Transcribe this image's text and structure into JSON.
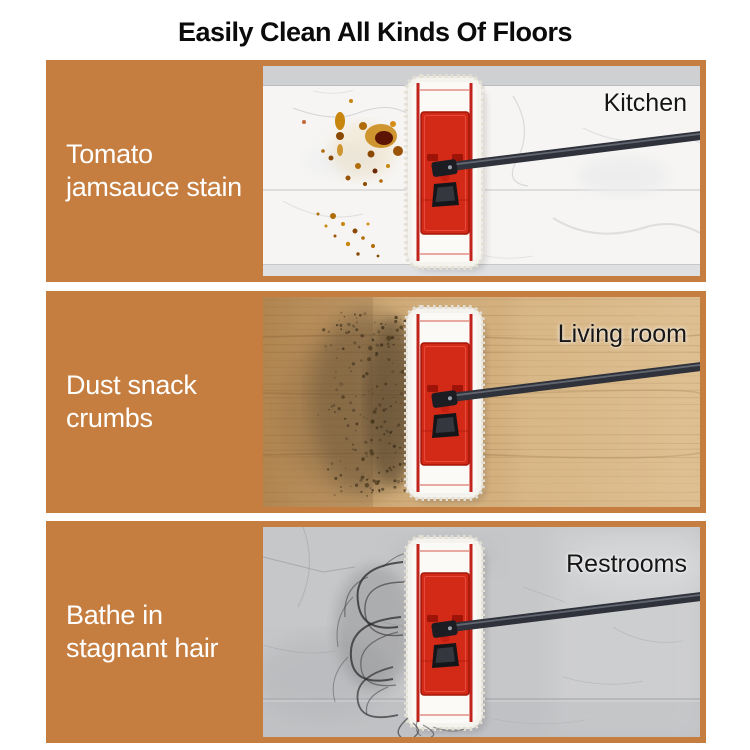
{
  "title": "Easily Clean All Kinds Of Floors",
  "colors": {
    "page_background": "#ffffff",
    "panel_orange": "#c57e40",
    "title_text": "#0b0b0b",
    "stain_label_text": "#ffffff",
    "room_label_text": "#161616",
    "mop_red": "#d32a18",
    "mop_pad_white": "#f5f3ee",
    "handle_dark": "#2f323a"
  },
  "panels": [
    {
      "stain_label": "Tomato\njamsauce stain",
      "room": "Kitchen",
      "floor_type": "marble"
    },
    {
      "stain_label": "Dust snack\ncrumbs",
      "room": "Living room",
      "floor_type": "wood"
    },
    {
      "stain_label": "Bathe in\nstagnant hair",
      "room": "Restrooms",
      "floor_type": "stone"
    }
  ]
}
